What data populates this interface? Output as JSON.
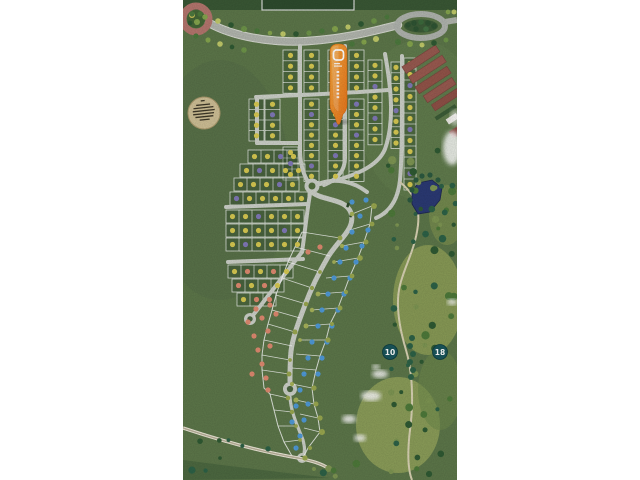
{
  "photo": {
    "x": 183,
    "y": 0,
    "width": 274,
    "height": 480,
    "description": "aerial photo of a residential golf-community scale model"
  },
  "golf_markers": [
    {
      "label": "10",
      "x": 390,
      "y": 352
    },
    {
      "label": "18",
      "x": 440,
      "y": 352
    }
  ],
  "pin": {
    "x": 338,
    "y": 44,
    "logo": "rounded-square-outline",
    "color_top": "#f7a93f",
    "color_bottom": "#e8741a"
  },
  "plaque": {
    "x": 204,
    "y": 113,
    "r": 16,
    "text_lines": 6
  },
  "palette": {
    "page_bg": "#ffffff",
    "grass": "#5d774a",
    "grass_light": "#66824f",
    "grass_dark": "#4c6741",
    "fairway": "#8fa058",
    "fairway2": "#93a35c",
    "road": "#b3b7af",
    "curb": "#d9dcd3",
    "street": "#cdd1c9",
    "lot_line": "rgba(255,255,255,0.8)",
    "lot_fill": "rgba(38,66,36,0.30)",
    "dot_yellow": "#d8ca52",
    "dot_purple": "#8179b8",
    "dot_salmon": "#e08a70",
    "dot_blue": "#4f9ad8",
    "olive": "#9aa84f",
    "tree_dark": "#2f5a33",
    "tree_teal": "#2d6247",
    "pond": "#2b3a74",
    "marker_teal": "#1a565c",
    "building": "#985a50",
    "building_dark": "#7c453e",
    "building_white": "#eceae4",
    "building_navy": "#39415c",
    "hedge": "#3c5c37",
    "roundabout_ring": "#b5766e",
    "path_tan": "#c9c2a2",
    "path_light": "#efeadb",
    "cloud": "#f4f4f2",
    "plaque_fill": "#cfc096",
    "plaque_edge": "#ab9a6d",
    "plaque_text": "#3e3828",
    "top_strip": "#3a5835",
    "top_rect": "#2e4c2e"
  },
  "scene": {
    "lot_columns": [
      {
        "x": 249,
        "y": 99,
        "w": 15,
        "cell": 10.5,
        "d": "YYYY"
      },
      {
        "x": 265,
        "y": 99,
        "w": 15,
        "cell": 10.5,
        "d": "YPYY"
      },
      {
        "x": 283,
        "y": 50,
        "w": 15,
        "cell": 10.8,
        "d": "YYYY"
      },
      {
        "x": 304,
        "y": 50,
        "w": 15,
        "cell": 10.8,
        "d": "YYYY"
      },
      {
        "x": 283,
        "y": 147,
        "w": 15,
        "cell": 11,
        "d": "YPY"
      },
      {
        "x": 304,
        "y": 99,
        "w": 15,
        "cell": 10.3,
        "d": "YPYYYYPY"
      },
      {
        "x": 328,
        "y": 50,
        "w": 15,
        "cell": 10.8,
        "d": "YYYY"
      },
      {
        "x": 328,
        "y": 99,
        "w": 15,
        "cell": 10.3,
        "d": "YYPYYPYY"
      },
      {
        "x": 349,
        "y": 50,
        "w": 15,
        "cell": 10.8,
        "d": "YYYY"
      },
      {
        "x": 349,
        "y": 99,
        "w": 15,
        "cell": 10.3,
        "d": "PYYPYYYY"
      },
      {
        "x": 368,
        "y": 60,
        "w": 14,
        "cell": 10.6,
        "d": "YYPYYPYY"
      },
      {
        "x": 391,
        "y": 62,
        "w": 10,
        "cell": 10.8,
        "d": "YYYYPYYY"
      },
      {
        "x": 404,
        "y": 58,
        "w": 12,
        "cell": 11,
        "d": "YYPYYYPYYYPY"
      }
    ],
    "lot_rows": [
      {
        "x": 248,
        "y": 150,
        "h": 13,
        "cell": 13,
        "d": "YYPY"
      },
      {
        "x": 240,
        "y": 164,
        "h": 13,
        "cell": 13,
        "d": "YPYYY"
      },
      {
        "x": 234,
        "y": 178,
        "h": 13,
        "cell": 13,
        "d": "YYYPY"
      },
      {
        "x": 230,
        "y": 192,
        "h": 13,
        "cell": 13,
        "d": "PYYYYY"
      },
      {
        "x": 226,
        "y": 210,
        "h": 13,
        "cell": 13,
        "d": "YYPYYY"
      },
      {
        "x": 226,
        "y": 224,
        "h": 13,
        "cell": 13,
        "d": "YYYYPY"
      },
      {
        "x": 226,
        "y": 238,
        "h": 13,
        "cell": 13,
        "d": "YPYYYY"
      },
      {
        "x": 228,
        "y": 265,
        "h": 13,
        "cell": 13,
        "d": "YSYSY"
      },
      {
        "x": 232,
        "y": 279,
        "h": 13,
        "cell": 13,
        "d": "SYSY"
      },
      {
        "x": 237,
        "y": 293,
        "h": 13,
        "cell": 13,
        "d": "YSS"
      }
    ],
    "streets": [
      "M300,46 L300,150 C300,166 304,177 311,186",
      "M345,46 L345,158 C345,172 336,180 324,185",
      "M385,54 C392,92 394,124 385,149 C377,169 348,178 320,184",
      "M402,56 C402,120 402,160 400,180 C398,200 390,212 376,218",
      "M256,97 C300,95 350,93 388,90",
      "M257,97 L257,143",
      "M257,143 L300,143",
      "M226,207 L308,204",
      "M228,262 L303,259",
      "M302,252 L254,314",
      "M311,188 C307,210 305,232 302,252",
      "M318,184 C336,177 354,182 367,192"
    ],
    "spine": "M312,192 C322,201 346,198 351,213 C356,229 338,240 328,257 C318,274 311,289 305,305 C299,321 293,336 291,351 C290,362 290,371 290,381",
    "spine_tail": "M290,397 C291,413 298,427 303,440 C305,448 305,452 303,456",
    "culdesacs": [
      {
        "x": 290,
        "y": 389,
        "r": 7
      },
      {
        "x": 250,
        "y": 319,
        "r": 6
      },
      {
        "x": 302,
        "y": 458,
        "r": 5
      }
    ],
    "junction": {
      "x": 312,
      "y": 186,
      "r": 5.5
    },
    "fan_lines_left": [
      [
        340,
        238,
        302,
        232
      ],
      [
        330,
        256,
        295,
        247
      ],
      [
        320,
        272,
        288,
        262
      ],
      [
        312,
        288,
        282,
        278
      ],
      [
        306,
        304,
        276,
        295
      ],
      [
        300,
        318,
        272,
        310
      ],
      [
        295,
        332,
        268,
        324
      ],
      [
        292,
        346,
        264,
        340
      ],
      [
        290,
        360,
        262,
        355
      ],
      [
        289,
        374,
        262,
        370
      ],
      [
        288,
        398,
        270,
        394
      ],
      [
        292,
        412,
        274,
        410
      ],
      [
        296,
        426,
        278,
        426
      ],
      [
        300,
        440,
        284,
        442
      ]
    ],
    "fan_lines_right": [
      [
        352,
        214,
        372,
        206
      ],
      [
        350,
        230,
        370,
        224
      ],
      [
        342,
        246,
        364,
        242
      ],
      [
        334,
        262,
        358,
        258
      ],
      [
        326,
        278,
        350,
        276
      ],
      [
        318,
        294,
        344,
        292
      ],
      [
        312,
        310,
        338,
        308
      ],
      [
        306,
        326,
        330,
        324
      ],
      [
        300,
        340,
        326,
        340
      ],
      [
        296,
        354,
        320,
        356
      ],
      [
        292,
        368,
        316,
        370
      ],
      [
        292,
        384,
        312,
        388
      ],
      [
        296,
        400,
        314,
        404
      ],
      [
        300,
        414,
        318,
        418
      ],
      [
        304,
        428,
        320,
        432
      ]
    ],
    "fan_outline_left": [
      [
        302,
        232
      ],
      [
        295,
        247
      ],
      [
        288,
        262
      ],
      [
        282,
        278
      ],
      [
        276,
        295
      ],
      [
        272,
        310
      ],
      [
        268,
        324
      ],
      [
        264,
        340
      ],
      [
        262,
        355
      ],
      [
        262,
        370
      ],
      [
        264,
        388
      ],
      [
        270,
        394
      ],
      [
        274,
        410
      ],
      [
        278,
        426
      ],
      [
        284,
        442
      ],
      [
        292,
        456
      ]
    ],
    "fan_outline_right": [
      [
        372,
        206
      ],
      [
        370,
        224
      ],
      [
        364,
        242
      ],
      [
        358,
        258
      ],
      [
        350,
        276
      ],
      [
        344,
        292
      ],
      [
        338,
        308
      ],
      [
        330,
        324
      ],
      [
        326,
        340
      ],
      [
        320,
        356
      ],
      [
        316,
        370
      ],
      [
        312,
        388
      ],
      [
        314,
        404
      ],
      [
        318,
        418
      ],
      [
        320,
        432
      ],
      [
        308,
        448
      ],
      [
        303,
        458
      ]
    ],
    "dots_blue": [
      [
        352,
        202
      ],
      [
        366,
        200
      ],
      [
        360,
        216
      ],
      [
        352,
        232
      ],
      [
        368,
        230
      ],
      [
        346,
        248
      ],
      [
        362,
        246
      ],
      [
        340,
        262
      ],
      [
        356,
        262
      ],
      [
        334,
        278
      ],
      [
        350,
        278
      ],
      [
        328,
        294
      ],
      [
        344,
        294
      ],
      [
        322,
        310
      ],
      [
        338,
        310
      ],
      [
        318,
        326
      ],
      [
        332,
        326
      ],
      [
        312,
        342
      ],
      [
        327,
        342
      ],
      [
        308,
        358
      ],
      [
        322,
        358
      ],
      [
        304,
        374
      ],
      [
        318,
        374
      ],
      [
        300,
        390
      ],
      [
        308,
        404
      ],
      [
        296,
        406
      ],
      [
        304,
        420
      ],
      [
        292,
        422
      ],
      [
        300,
        436
      ],
      [
        296,
        448
      ]
    ],
    "dots_salmon": [
      [
        256,
        309
      ],
      [
        270,
        305
      ],
      [
        248,
        322
      ],
      [
        262,
        318
      ],
      [
        276,
        314
      ],
      [
        254,
        336
      ],
      [
        268,
        331
      ],
      [
        258,
        350
      ],
      [
        270,
        346
      ],
      [
        262,
        364
      ],
      [
        252,
        374
      ],
      [
        266,
        378
      ],
      [
        268,
        390
      ],
      [
        320,
        247
      ],
      [
        308,
        252
      ]
    ],
    "vehicles": [
      [
        348,
        205
      ],
      [
        351,
        215
      ]
    ],
    "tree_colors": [
      "#4d7a3e",
      "#86a64e",
      "#c2cb6a",
      "#2f5a33",
      "#6f964a"
    ],
    "tree_rows": [
      [
        [
          192,
          14
        ],
        [
          205,
          17
        ],
        [
          218,
          21
        ],
        [
          231,
          25
        ],
        [
          244,
          29
        ],
        [
          257,
          31
        ],
        [
          270,
          33
        ],
        [
          283,
          34
        ],
        [
          296,
          34
        ],
        [
          309,
          33
        ],
        [
          322,
          31
        ],
        [
          335,
          29
        ],
        [
          348,
          27
        ],
        [
          361,
          24
        ],
        [
          374,
          21
        ],
        [
          387,
          17
        ],
        [
          448,
          12
        ],
        [
          454,
          12
        ]
      ],
      [
        [
          196,
          36
        ],
        [
          208,
          40
        ],
        [
          220,
          44
        ],
        [
          232,
          47
        ],
        [
          244,
          50
        ]
      ],
      [
        [
          352,
          44
        ],
        [
          364,
          42
        ],
        [
          376,
          39
        ]
      ],
      [
        [
          398,
          42
        ],
        [
          410,
          44
        ],
        [
          422,
          45
        ],
        [
          434,
          43
        ],
        [
          446,
          40
        ]
      ]
    ],
    "marker_tree_line": [
      [
        412,
        338
      ],
      [
        410,
        346
      ],
      [
        413,
        354
      ],
      [
        410,
        362
      ],
      [
        413,
        370
      ],
      [
        411,
        377
      ]
    ],
    "scatter": [
      {
        "x": 388,
        "y": 150,
        "w": 66,
        "h": 120,
        "n": 26
      },
      {
        "x": 385,
        "y": 280,
        "w": 70,
        "h": 120,
        "n": 20
      },
      {
        "x": 390,
        "y": 400,
        "w": 64,
        "h": 76,
        "n": 14
      },
      {
        "x": 186,
        "y": 440,
        "w": 90,
        "h": 36,
        "n": 8
      },
      {
        "x": 310,
        "y": 455,
        "w": 60,
        "h": 22,
        "n": 6
      },
      {
        "x": 440,
        "y": 185,
        "w": 16,
        "h": 45,
        "n": 6
      }
    ],
    "pond_edge_trees": [
      [
        416,
        180
      ],
      [
        422,
        176
      ],
      [
        430,
        175
      ],
      [
        438,
        180
      ],
      [
        412,
        190
      ],
      [
        410,
        200
      ]
    ],
    "golf_path": "M400,182 C415,195 420,205 418,225 C415,250 405,265 400,285 C395,305 400,330 406,350 C412,370 414,400 410,430 C407,455 408,470 412,480",
    "bottom_path": "M183,428 C225,442 262,452 298,458 C312,461 320,463 328,468",
    "clouds": [
      {
        "x": 380,
        "y": 374,
        "rx": 8,
        "ry": 4
      },
      {
        "x": 371,
        "y": 396,
        "rx": 10,
        "ry": 5
      },
      {
        "x": 349,
        "y": 419,
        "rx": 7,
        "ry": 4
      },
      {
        "x": 360,
        "y": 438,
        "rx": 6,
        "ry": 3.5
      },
      {
        "x": 376,
        "y": 367,
        "rx": 4,
        "ry": 2.5
      },
      {
        "x": 452,
        "y": 302,
        "rx": 5,
        "ry": 3
      }
    ]
  }
}
